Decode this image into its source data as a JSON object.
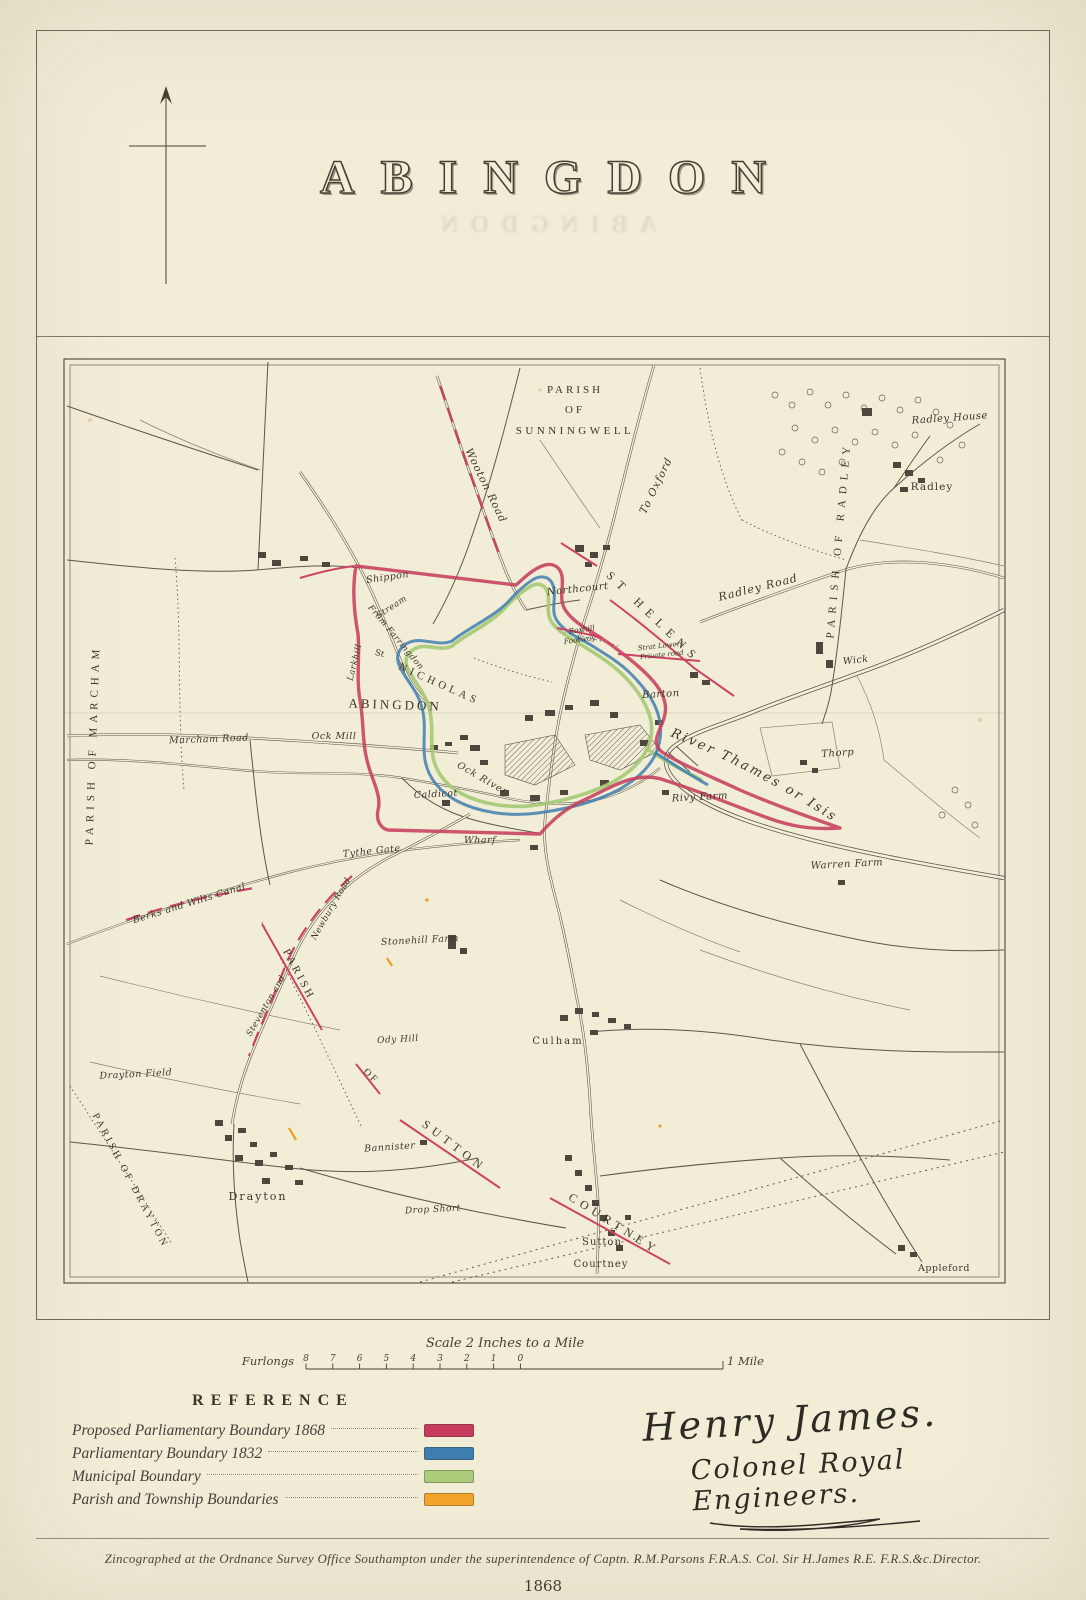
{
  "page": {
    "title": "ABINGDON",
    "year": "1868",
    "imprint": "Zincographed at the Ordnance Survey Office Southampton under the superintendence of Captn. R.M.Parsons F.R.A.S. Col. Sir H.James R.E. F.R.S.&c.Director."
  },
  "signature": {
    "line1": "Henry James.",
    "line2": "Colonel Royal Engineers."
  },
  "scale_bar": {
    "title": "Scale 2 Inches to a Mile",
    "left_label": "Furlongs",
    "tick_labels": [
      "8",
      "7",
      "6",
      "5",
      "4",
      "3",
      "2",
      "1",
      "0"
    ],
    "right_label": "1 Mile"
  },
  "legend": {
    "heading": "REFERENCE",
    "items": [
      {
        "label": "Proposed Parliamentary Boundary 1868",
        "color": "#c63b5e"
      },
      {
        "label": "Parliamentary Boundary 1832",
        "color": "#3f7fb0"
      },
      {
        "label": "Municipal Boundary",
        "color": "#accd7c"
      },
      {
        "label": "Parish and Township Boundaries",
        "color": "#f3a62c"
      }
    ]
  },
  "map": {
    "labels": [
      {
        "id": "parish-sunningwell-line1",
        "t": "PARISH",
        "x": 575,
        "y": 393,
        "r": 0,
        "c": "caps",
        "s": 11,
        "ls": 3
      },
      {
        "id": "parish-sunningwell-line2",
        "t": "OF",
        "x": 575,
        "y": 413,
        "r": 0,
        "c": "caps",
        "s": 11,
        "ls": 3
      },
      {
        "id": "parish-sunningwell-line3",
        "t": "SUNNINGWELL",
        "x": 575,
        "y": 434,
        "r": 0,
        "c": "caps",
        "s": 11,
        "ls": 3.5
      },
      {
        "id": "parish-of-radley",
        "t": "PARISH OF RADLEY",
        "x": 842,
        "y": 540,
        "r": -85,
        "c": "caps",
        "s": 11,
        "ls": 6
      },
      {
        "id": "parish-of-marcham",
        "t": "PARISH OF MARCHAM",
        "x": 96,
        "y": 745,
        "r": -88,
        "c": "caps",
        "s": 11,
        "ls": 5
      },
      {
        "id": "wooton-road",
        "t": "Wooton Road",
        "x": 483,
        "y": 487,
        "r": 64,
        "c": "it",
        "s": 10.5,
        "ls": 1
      },
      {
        "id": "to-oxford",
        "t": "To Oxford",
        "x": 659,
        "y": 487,
        "r": -64,
        "c": "it",
        "s": 10.5,
        "ls": 1
      },
      {
        "id": "radley-house",
        "t": "Radley House",
        "x": 950,
        "y": 421,
        "r": -4,
        "c": "it",
        "s": 10,
        "ls": 0.5
      },
      {
        "id": "radley",
        "t": "Radley",
        "x": 932,
        "y": 490,
        "r": 0,
        "c": "rom",
        "s": 10.5,
        "ls": 1
      },
      {
        "id": "radley-road",
        "t": "Radley Road",
        "x": 759,
        "y": 591,
        "r": -14,
        "c": "it",
        "s": 11,
        "ls": 1
      },
      {
        "id": "wick",
        "t": "Wick",
        "x": 856,
        "y": 663,
        "r": -6,
        "c": "it",
        "s": 9.5,
        "ls": 0.5
      },
      {
        "id": "st-helens",
        "t": "ST HELENS",
        "x": 651,
        "y": 620,
        "r": 44,
        "c": "caps",
        "s": 12,
        "ls": 7
      },
      {
        "id": "shippon",
        "t": "Shippon",
        "x": 388,
        "y": 580,
        "r": -8,
        "c": "it",
        "s": 9.5,
        "ls": 0.5
      },
      {
        "id": "stream",
        "t": "Stream",
        "x": 393,
        "y": 609,
        "r": -33,
        "c": "it",
        "s": 8.5,
        "ls": 0.5
      },
      {
        "id": "larkhill",
        "t": "Larkhill",
        "x": 357,
        "y": 663,
        "r": -76,
        "c": "it",
        "s": 8.5,
        "ls": 0.5
      },
      {
        "id": "from-farringdon",
        "t": "From Farringdon",
        "x": 394,
        "y": 639,
        "r": 50,
        "c": "it",
        "s": 8.5,
        "ls": 0.5
      },
      {
        "id": "st-nicholas-st",
        "t": "St",
        "x": 379,
        "y": 656,
        "r": 15,
        "c": "rom",
        "s": 8.5,
        "ls": 0
      },
      {
        "id": "st-nicholas",
        "t": "NICHOLAS",
        "x": 438,
        "y": 687,
        "r": 24,
        "c": "caps",
        "s": 11,
        "ls": 4
      },
      {
        "id": "abingdon-town",
        "t": "ABINGDON",
        "x": 395,
        "y": 709,
        "r": 2,
        "c": "caps",
        "s": 13,
        "ls": 3
      },
      {
        "id": "northcourt",
        "t": "Northcourt",
        "x": 578,
        "y": 592,
        "r": -6,
        "c": "it",
        "s": 10,
        "ls": 0.5
      },
      {
        "id": "boxhill",
        "t": "Boxhill",
        "x": 582,
        "y": 632,
        "r": -8,
        "c": "it",
        "s": 7.5,
        "ls": 0
      },
      {
        "id": "footway",
        "t": "Footway",
        "x": 580,
        "y": 642,
        "r": -8,
        "c": "it",
        "s": 7.5,
        "ls": 0
      },
      {
        "id": "strat-lowers",
        "t": "Strat Lowers",
        "x": 661,
        "y": 648,
        "r": -6,
        "c": "it",
        "s": 7,
        "ls": 0
      },
      {
        "id": "private-road",
        "t": "Private road",
        "x": 662,
        "y": 657,
        "r": -6,
        "c": "it",
        "s": 7,
        "ls": 0
      },
      {
        "id": "barton",
        "t": "Barton",
        "x": 661,
        "y": 697,
        "r": -3,
        "c": "it",
        "s": 10,
        "ls": 0.5
      },
      {
        "id": "ock-mill",
        "t": "Ock Mill",
        "x": 334,
        "y": 739,
        "r": 0,
        "c": "it",
        "s": 9.5,
        "ls": 0.5
      },
      {
        "id": "marcham-road",
        "t": "Marcham Road",
        "x": 209,
        "y": 742,
        "r": -2,
        "c": "it",
        "s": 9.5,
        "ls": 0.5
      },
      {
        "id": "ock-river",
        "t": "Ock River",
        "x": 481,
        "y": 781,
        "r": 30,
        "c": "it",
        "s": 9.5,
        "ls": 1
      },
      {
        "id": "caldicot",
        "t": "Caldicot",
        "x": 436,
        "y": 797,
        "r": -3,
        "c": "it",
        "s": 9.5,
        "ls": 0.5
      },
      {
        "id": "wharf",
        "t": "Wharf",
        "x": 480,
        "y": 843,
        "r": 0,
        "c": "it",
        "s": 9.5,
        "ls": 0.5
      },
      {
        "id": "river-thames-or-isis",
        "t": "River Thames or Isis",
        "p": "river-label-path",
        "o": "4%",
        "c": "it",
        "s": 13,
        "ls": 2.5
      },
      {
        "id": "thorp",
        "t": "Thorp",
        "x": 838,
        "y": 756,
        "r": -4,
        "c": "it",
        "s": 10,
        "ls": 0.5
      },
      {
        "id": "rivy-farm",
        "t": "Rivy Farm",
        "x": 700,
        "y": 800,
        "r": -3,
        "c": "it",
        "s": 10,
        "ls": 0.5
      },
      {
        "id": "warren-farm",
        "t": "Warren Farm",
        "x": 847,
        "y": 867,
        "r": -3,
        "c": "it",
        "s": 10,
        "ls": 0.5
      },
      {
        "id": "tythe-gate",
        "t": "Tythe Gate",
        "x": 372,
        "y": 854,
        "r": -6,
        "c": "it",
        "s": 9.5,
        "ls": 0.5
      },
      {
        "id": "berks-and-wilts-canal",
        "t": "Berks and Wilts Canal",
        "x": 190,
        "y": 906,
        "r": -17,
        "c": "it",
        "s": 9.5,
        "ls": 0.5
      },
      {
        "id": "steventon-and",
        "t": "Steventon and",
        "x": 268,
        "y": 1007,
        "r": -60,
        "c": "it",
        "s": 8.5,
        "ls": 0.5
      },
      {
        "id": "newbury-road",
        "t": "Newbury Road",
        "x": 333,
        "y": 910,
        "r": -60,
        "c": "it",
        "s": 8.5,
        "ls": 0.5
      },
      {
        "id": "parish-sutton",
        "t": "PARISH",
        "x": 296,
        "y": 976,
        "r": 62,
        "c": "caps",
        "s": 11,
        "ls": 3
      },
      {
        "id": "of-sutton",
        "t": "OF",
        "x": 369,
        "y": 1078,
        "r": 45,
        "c": "caps",
        "s": 10,
        "ls": 2
      },
      {
        "id": "sutton-caps",
        "t": "SUTTON",
        "x": 452,
        "y": 1149,
        "r": 37,
        "c": "caps",
        "s": 12,
        "ls": 5
      },
      {
        "id": "courtney-caps",
        "t": "COURTNEY",
        "x": 612,
        "y": 1227,
        "r": 32,
        "c": "caps",
        "s": 12,
        "ls": 5
      },
      {
        "id": "stonehill-farm",
        "t": "Stonehill Farm",
        "x": 420,
        "y": 943,
        "r": -3,
        "c": "it",
        "s": 9.5,
        "ls": 0.5
      },
      {
        "id": "ody-hill",
        "t": "Ody Hill",
        "x": 398,
        "y": 1042,
        "r": -3,
        "c": "it",
        "s": 9,
        "ls": 0.5
      },
      {
        "id": "drayton-field",
        "t": "Drayton Field",
        "x": 136,
        "y": 1077,
        "r": -3,
        "c": "it",
        "s": 9.5,
        "ls": 0.5
      },
      {
        "id": "parish-of-drayton",
        "t": "PARISH OF DRAYTON",
        "x": 128,
        "y": 1182,
        "r": 62,
        "c": "caps",
        "s": 10,
        "ls": 3
      },
      {
        "id": "drayton",
        "t": "Drayton",
        "x": 258,
        "y": 1200,
        "r": 0,
        "c": "rom",
        "s": 11,
        "ls": 2
      },
      {
        "id": "bannister",
        "t": "Bannister",
        "x": 390,
        "y": 1150,
        "r": -4,
        "c": "it",
        "s": 9.5,
        "ls": 0.5
      },
      {
        "id": "culham",
        "t": "Culham",
        "x": 558,
        "y": 1044,
        "r": 0,
        "c": "rom",
        "s": 10,
        "ls": 2
      },
      {
        "id": "drop-short",
        "t": "Drop Short",
        "x": 433,
        "y": 1212,
        "r": -3,
        "c": "it",
        "s": 9,
        "ls": 0.5
      },
      {
        "id": "sutton-village",
        "t": "Sutton",
        "x": 602,
        "y": 1245,
        "r": 0,
        "c": "rom",
        "s": 10,
        "ls": 1
      },
      {
        "id": "courtney-village",
        "t": "Courtney",
        "x": 601,
        "y": 1267,
        "r": 0,
        "c": "rom",
        "s": 10,
        "ls": 1
      },
      {
        "id": "appleford",
        "t": "Appleford",
        "x": 944,
        "y": 1271,
        "r": 0,
        "c": "rom",
        "s": 9.5,
        "ls": 0.5
      }
    ]
  }
}
